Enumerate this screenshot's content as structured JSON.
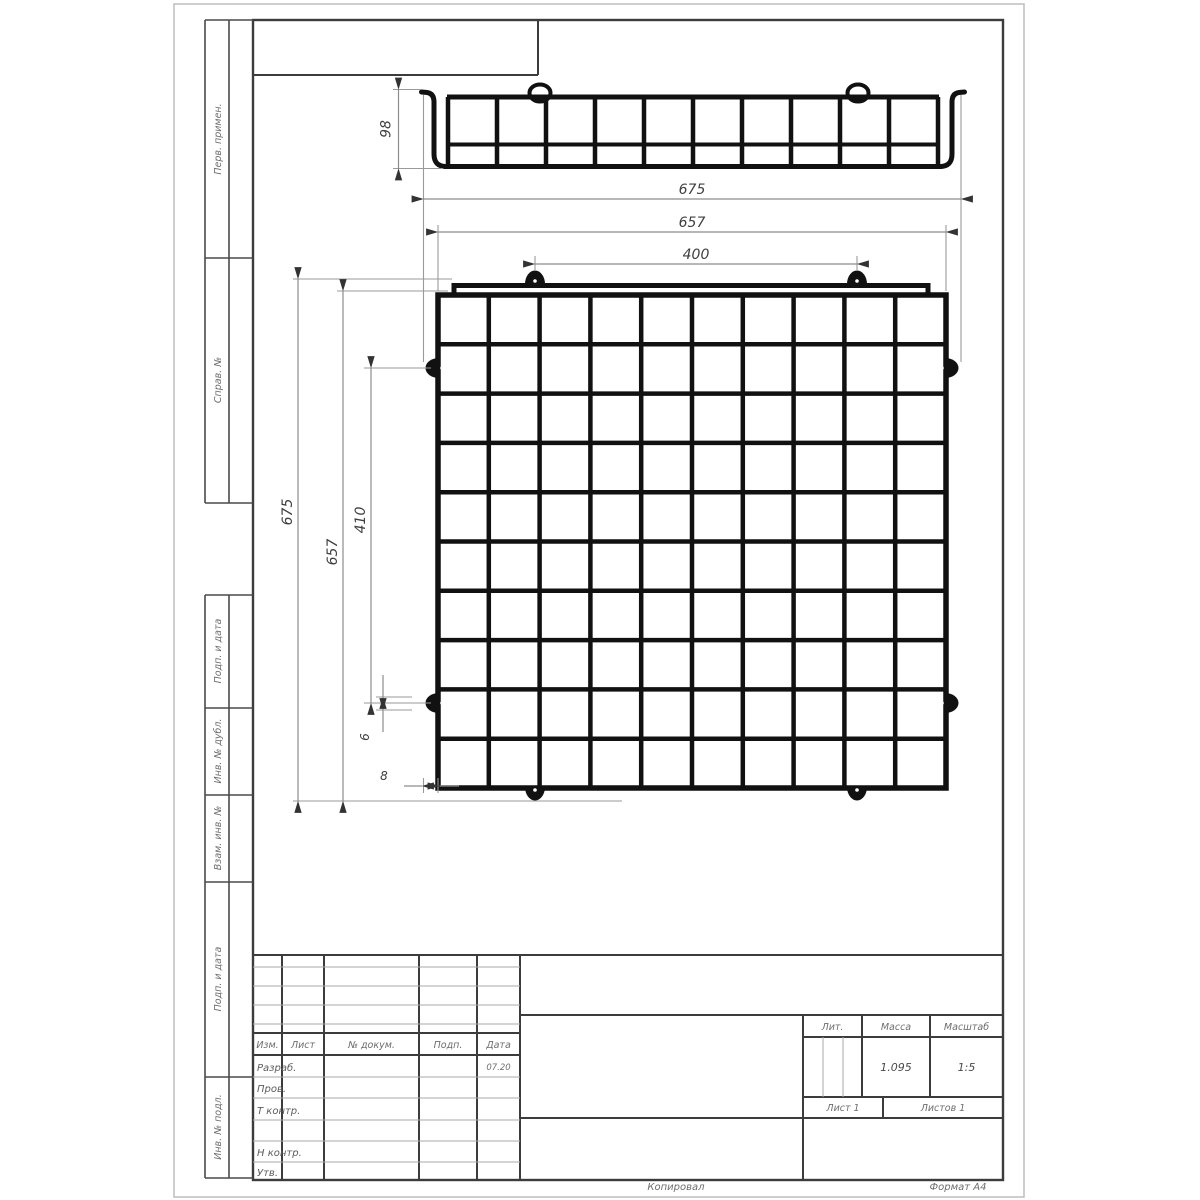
{
  "dimensions": {
    "side_height": "98",
    "overall_width": "675",
    "mesh_width": "657",
    "clip_span_h": "400",
    "overall_height": "675",
    "mesh_height": "657",
    "clip_span_v": "410",
    "wire_dia": "6",
    "edge_offset": "8"
  },
  "left_strip": {
    "items": [
      "Перв. примен.",
      "Справ. №",
      "Подп. и дата",
      "Инв. № дубл.",
      "Взам. инв. №",
      "Подп. и дата",
      "Инв. № подл."
    ]
  },
  "title_block": {
    "header": {
      "izm": "Изм.",
      "list": "Лист",
      "doc": "№ докум.",
      "podp": "Подп.",
      "data": "Дата"
    },
    "rows": {
      "razrab": "Разраб.",
      "prov": "Пров.",
      "tkontr": "Т контр.",
      "nkontr": "Н контр.",
      "utv": "Утв."
    },
    "razrab_date": "07.20",
    "lit_label": "Лит.",
    "mass_label": "Масса",
    "scale_label": "Масштаб",
    "mass_value": "1.095",
    "scale_value": "1:5",
    "sheet_label": "Лист 1",
    "sheets_label": "Листов 1"
  },
  "footer": {
    "copied": "Копировал",
    "format": "Формат А4"
  }
}
